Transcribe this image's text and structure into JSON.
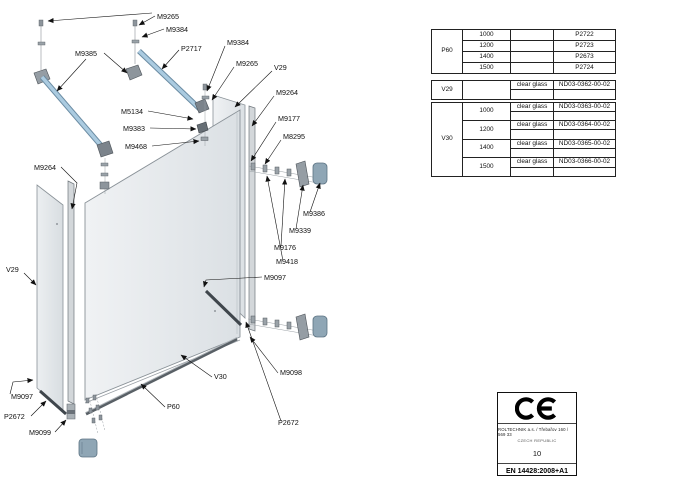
{
  "page": {
    "title": "Walk-in shower enclosure exploded assembly drawing"
  },
  "diagram": {
    "labels": [
      {
        "t": "M9265",
        "x": 157,
        "y": 19,
        "pts": [
          [
            155,
            16
          ],
          [
            139,
            25
          ]
        ]
      },
      {
        "t": "M9384",
        "x": 166,
        "y": 32,
        "pts": [
          [
            164,
            29
          ],
          [
            142,
            37
          ]
        ]
      },
      {
        "t": "P2717",
        "x": 181,
        "y": 51,
        "pts": [
          [
            179,
            50
          ],
          [
            162,
            69
          ]
        ]
      },
      {
        "t": "M9385",
        "x": 75,
        "y": 56,
        "pts": [
          [
            104,
            53
          ],
          [
            127,
            73
          ]
        ]
      },
      {
        "t": "M9384",
        "x": 227,
        "y": 45,
        "pts": [
          [
            225,
            46
          ],
          [
            207,
            91
          ]
        ]
      },
      {
        "t": "M9265",
        "x": 236,
        "y": 66,
        "pts": [
          [
            234,
            67
          ],
          [
            212,
            100
          ]
        ]
      },
      {
        "t": "V29",
        "x": 274,
        "y": 70,
        "pts": [
          [
            272,
            71
          ],
          [
            235,
            107
          ]
        ]
      },
      {
        "t": "M9264",
        "x": 276,
        "y": 95,
        "pts": [
          [
            274,
            96
          ],
          [
            252,
            126
          ]
        ]
      },
      {
        "t": "M9177",
        "x": 278,
        "y": 121,
        "pts": [
          [
            276,
            122
          ],
          [
            251,
            161
          ]
        ]
      },
      {
        "t": "M8295",
        "x": 283,
        "y": 139,
        "pts": [
          [
            281,
            140
          ],
          [
            265,
            164
          ]
        ]
      },
      {
        "t": "M5134",
        "x": 121,
        "y": 114,
        "pts": [
          [
            148,
            111
          ],
          [
            193,
            119
          ]
        ]
      },
      {
        "t": "M9383",
        "x": 123,
        "y": 131,
        "pts": [
          [
            150,
            128
          ],
          [
            196,
            129
          ]
        ]
      },
      {
        "t": "M9468",
        "x": 125,
        "y": 149,
        "pts": [
          [
            152,
            146
          ],
          [
            199,
            141
          ]
        ]
      },
      {
        "t": "M9264",
        "x": 34,
        "y": 170,
        "pts": [
          [
            61,
            167
          ],
          [
            77,
            183
          ],
          [
            72,
            209
          ]
        ]
      },
      {
        "t": "V29",
        "x": 6,
        "y": 272,
        "pts": [
          [
            24,
            273
          ],
          [
            36,
            285
          ]
        ]
      },
      {
        "t": "M9386",
        "x": 303,
        "y": 216,
        "pts": [
          [
            310,
            212
          ],
          [
            320,
            183
          ]
        ]
      },
      {
        "t": "M9339",
        "x": 289,
        "y": 233,
        "pts": [
          [
            296,
            229
          ],
          [
            303,
            185
          ]
        ]
      },
      {
        "t": "M9176",
        "x": 274,
        "y": 250,
        "pts": [
          [
            281,
            246
          ],
          [
            285,
            179
          ]
        ]
      },
      {
        "t": "M9418",
        "x": 276,
        "y": 264,
        "pts": [
          [
            283,
            261
          ],
          [
            267,
            176
          ]
        ]
      },
      {
        "t": "M9097",
        "x": 264,
        "y": 280,
        "pts": [
          [
            262,
            277
          ],
          [
            206,
            280
          ],
          [
            204,
            287
          ]
        ]
      },
      {
        "t": "M9097",
        "x": 11,
        "y": 399,
        "pts": [
          [
            10,
            394
          ],
          [
            13,
            382
          ],
          [
            33,
            380
          ]
        ]
      },
      {
        "t": "P2672",
        "x": 4,
        "y": 419,
        "pts": [
          [
            31,
            416
          ],
          [
            46,
            401
          ]
        ]
      },
      {
        "t": "M9099",
        "x": 29,
        "y": 435,
        "pts": [
          [
            55,
            432
          ],
          [
            66,
            420
          ]
        ]
      },
      {
        "t": "V30",
        "x": 214,
        "y": 379,
        "pts": [
          [
            212,
            377
          ],
          [
            181,
            355
          ]
        ]
      },
      {
        "t": "P60",
        "x": 167,
        "y": 409,
        "pts": [
          [
            165,
            407
          ],
          [
            141,
            384
          ]
        ]
      },
      {
        "t": "M9098",
        "x": 280,
        "y": 375,
        "pts": [
          [
            278,
            373
          ],
          [
            250,
            337
          ]
        ]
      },
      {
        "t": "P2672",
        "x": 278,
        "y": 425,
        "pts": [
          [
            281,
            421
          ],
          [
            246,
            322
          ]
        ]
      }
    ],
    "extra_leaders": [
      {
        "pts": [
          [
            86,
            59
          ],
          [
            57,
            91
          ]
        ]
      },
      {
        "pts": [
          [
            152,
            13
          ],
          [
            48,
            21
          ]
        ]
      }
    ]
  },
  "tables": {
    "t1": {
      "group": "P60",
      "rows": [
        {
          "size": "1000",
          "code": "P2722"
        },
        {
          "size": "1200",
          "code": "P2723"
        },
        {
          "size": "1400",
          "code": "P2673"
        },
        {
          "size": "1500",
          "code": "P2724"
        }
      ]
    },
    "t2a": {
      "group": "V29",
      "desc": "clear glass",
      "code": "ND03-0362-00-02"
    },
    "t2b": {
      "group": "V30",
      "rows": [
        {
          "size": "1000",
          "desc": "clear glass",
          "code": "ND03-0363-00-02"
        },
        {
          "size": "1200",
          "desc": "clear glass",
          "code": "ND03-0364-00-02"
        },
        {
          "size": "1400",
          "desc": "clear glass",
          "code": "ND03-0365-00-02"
        },
        {
          "size": "1500",
          "desc": "clear glass",
          "code": "ND03-0366-00-02"
        }
      ]
    }
  },
  "ce_box": {
    "mark": "CE",
    "address_line1": "ROLTECHNIK a.s. / Třebařov 160 / 569 33",
    "address_line2": "CZECH REPUBLIC",
    "number": "10",
    "standard": "EN 14428:2008+A1"
  }
}
